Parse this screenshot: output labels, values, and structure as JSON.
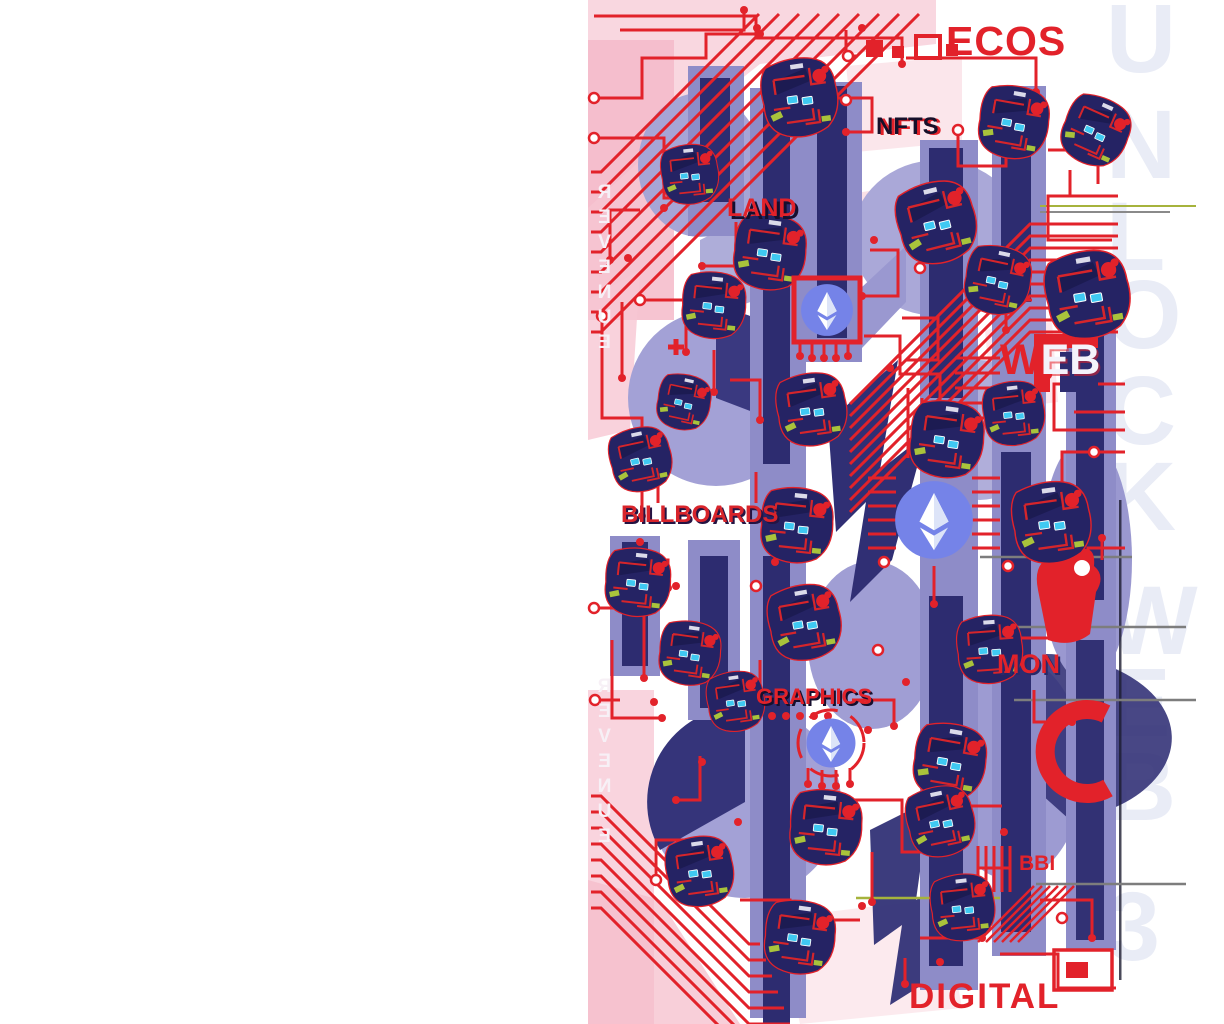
{
  "artwork": {
    "title_fragments": {
      "ecosystem": "ECOS",
      "unlock_watermark": "UNLOCK WEB 3"
    },
    "labels": {
      "nfts": "NFTS",
      "land": "LAND",
      "web_w": "W",
      "web_eb": "EB",
      "billboards": "BILLBOARDS",
      "graphics": "GRAPHICS",
      "monetize_fragment": "MON",
      "bbi_fragment": "BBI",
      "digital": "DIGITAL",
      "revenue_top": "REVENUE",
      "revenue_bottom": "REVENUE"
    },
    "watermark_letters": [
      {
        "ch": "U",
        "top": -10
      },
      {
        "ch": "N",
        "top": 96
      },
      {
        "ch": "L",
        "top": 188
      },
      {
        "ch": "O",
        "top": 266
      },
      {
        "ch": "C",
        "top": 362
      },
      {
        "ch": "K",
        "top": 448
      },
      {
        "ch": "W",
        "top": 572
      },
      {
        "ch": "E",
        "top": 654
      },
      {
        "ch": "B",
        "top": 738
      },
      {
        "ch": "3",
        "top": 878
      }
    ],
    "colors": {
      "circuit_red": "#E2222A",
      "chip_navy": "#252364",
      "bar_navy": "#2D2C70",
      "periwinkle": "#8E8CC8",
      "light_periwinkle": "#A7A5D6",
      "pink": "#F5BAC9",
      "watermark_gray": "#E9ECF6",
      "eth_blue": "#7583E8",
      "cyan": "#3FC9F2",
      "lime": "#A9C33B"
    },
    "icons": [
      "ethereum-icon",
      "chip-bot-icon"
    ]
  }
}
